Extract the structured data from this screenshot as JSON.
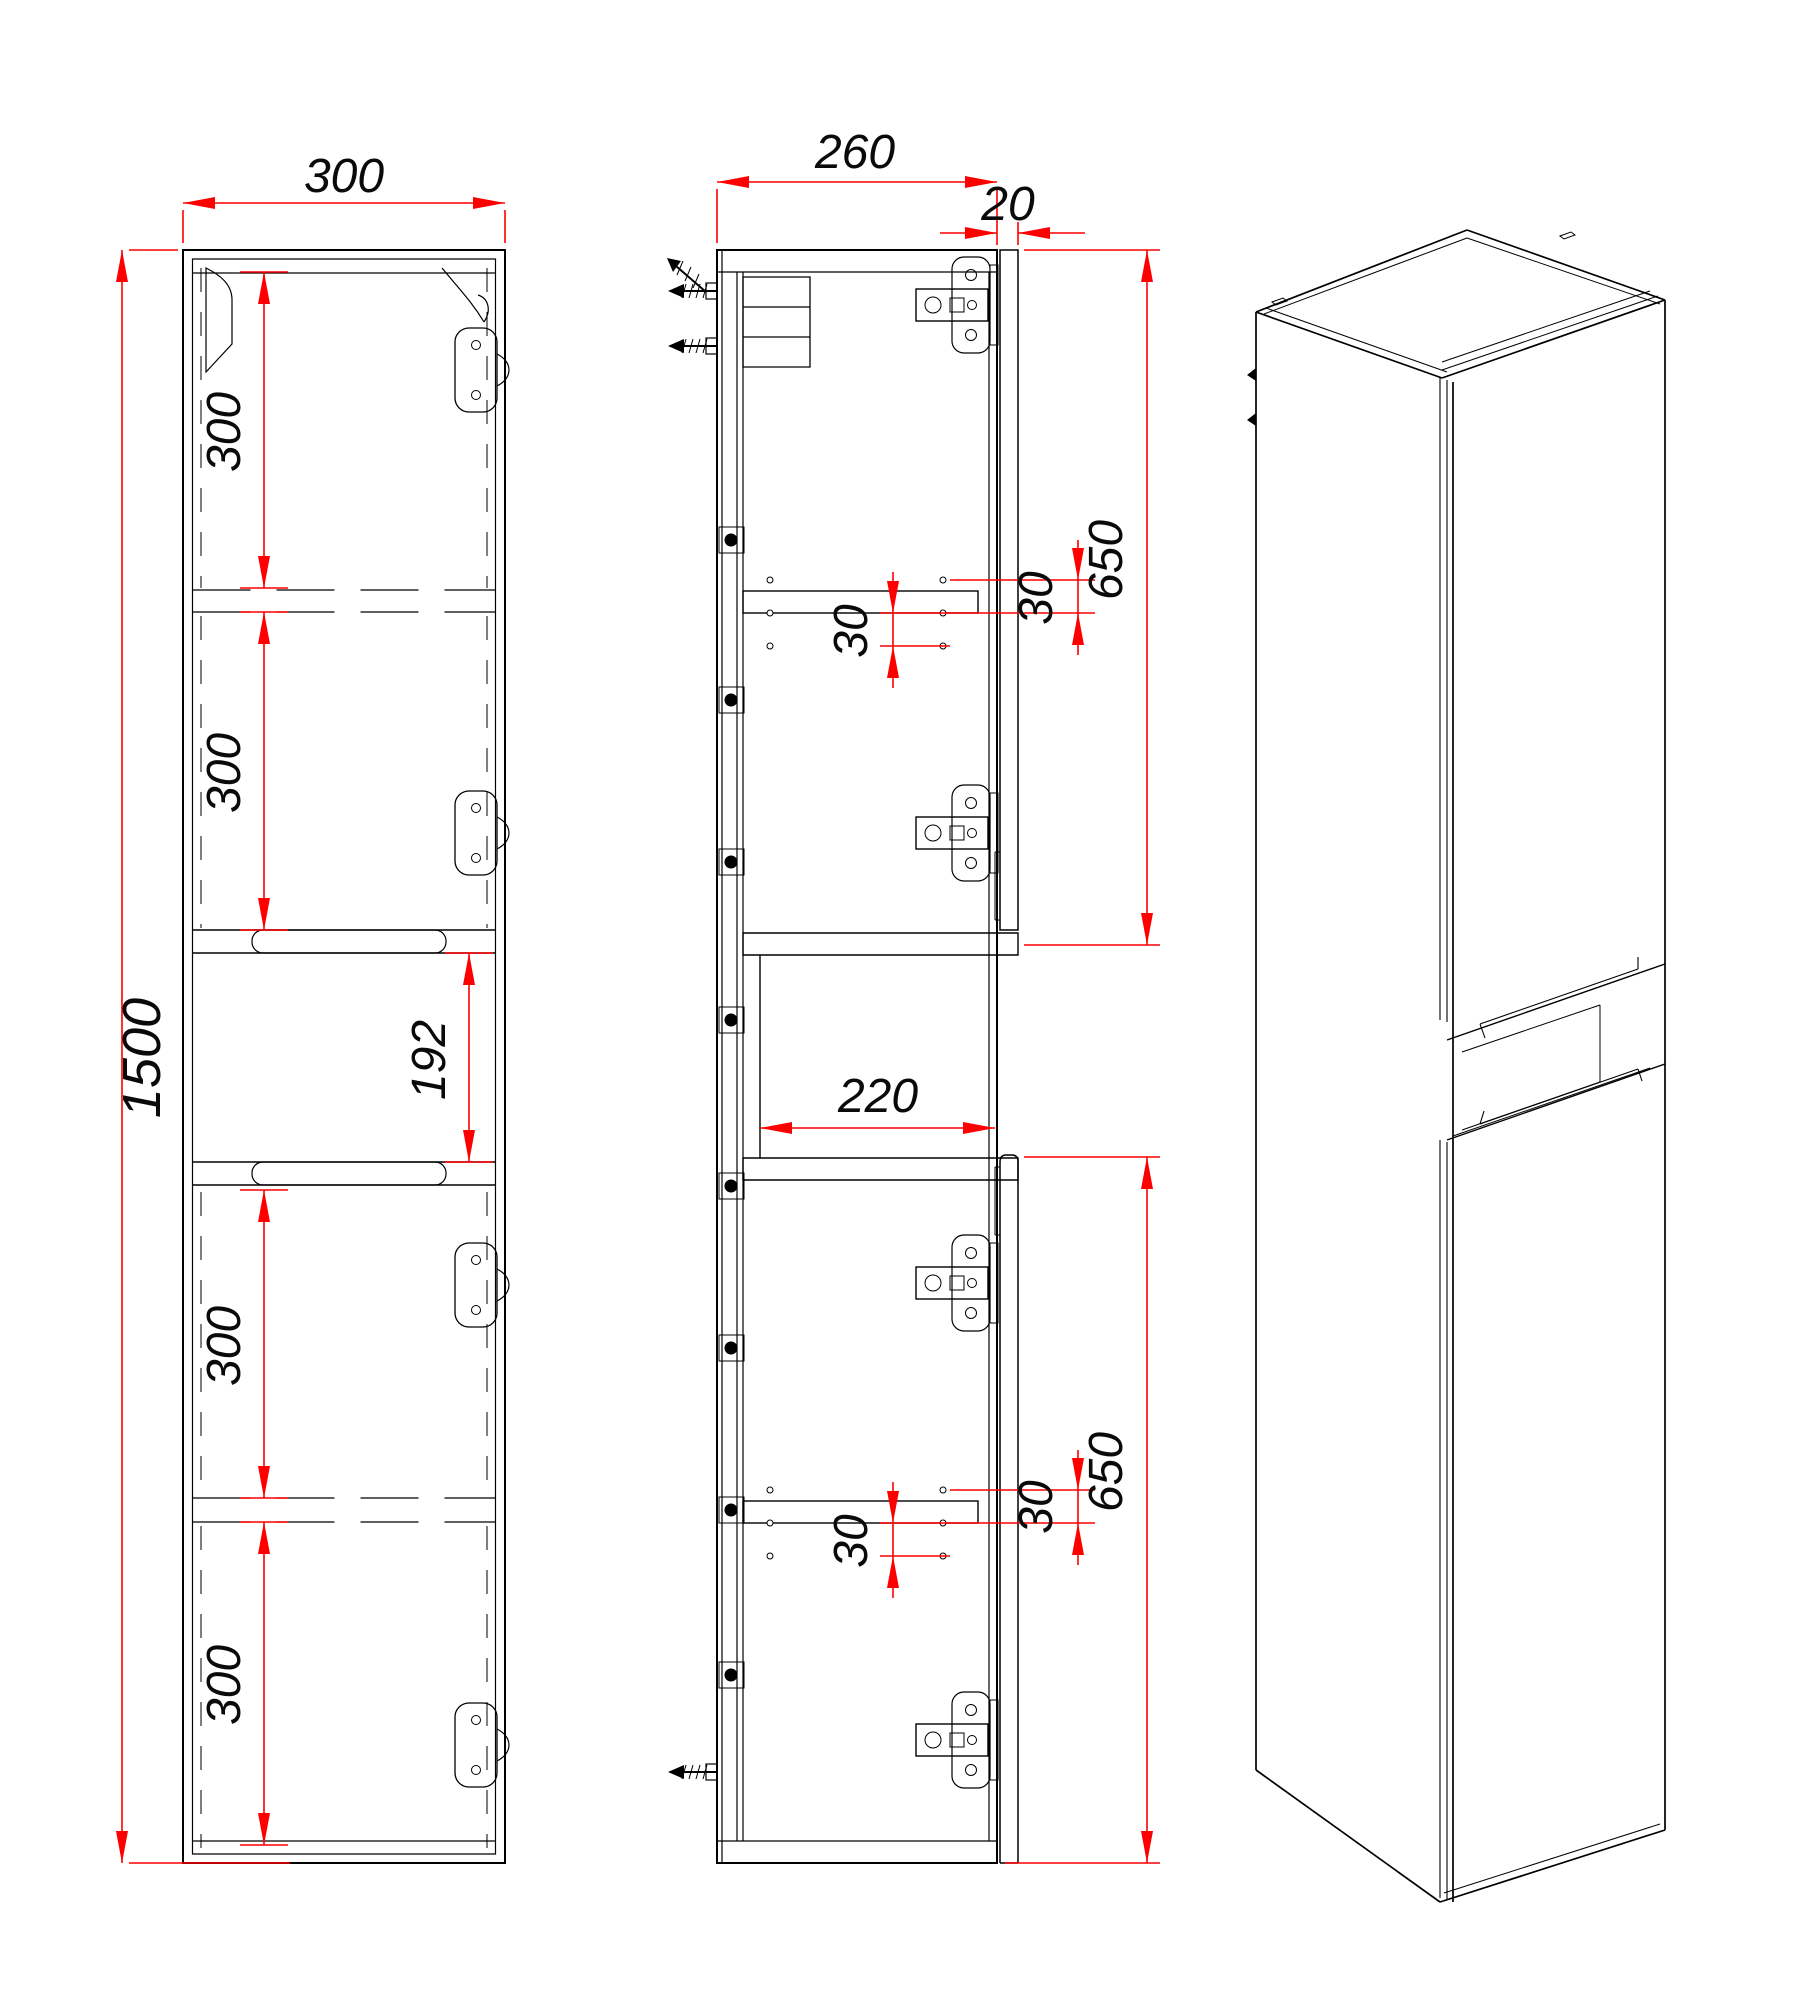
{
  "drawing_type": "furniture-cabinet-technical-drawing",
  "colors": {
    "line": "#000000",
    "dimension": "#ff0000",
    "background": "#ffffff"
  },
  "views": {
    "front": {
      "dims": {
        "width": "300",
        "height": "1500",
        "top_section_a": "300",
        "top_section_b": "300",
        "niche_height": "192",
        "bottom_section_a": "300",
        "bottom_section_b": "300"
      }
    },
    "side": {
      "dims": {
        "depth": "260",
        "door_thickness": "20",
        "upper_door_height": "650",
        "upper_hole_pitch_front": "30",
        "upper_hole_pitch_back": "30",
        "niche_depth": "220",
        "lower_door_height": "650",
        "lower_hole_pitch_front": "30",
        "lower_hole_pitch_back": "30"
      }
    },
    "isometric": {}
  }
}
